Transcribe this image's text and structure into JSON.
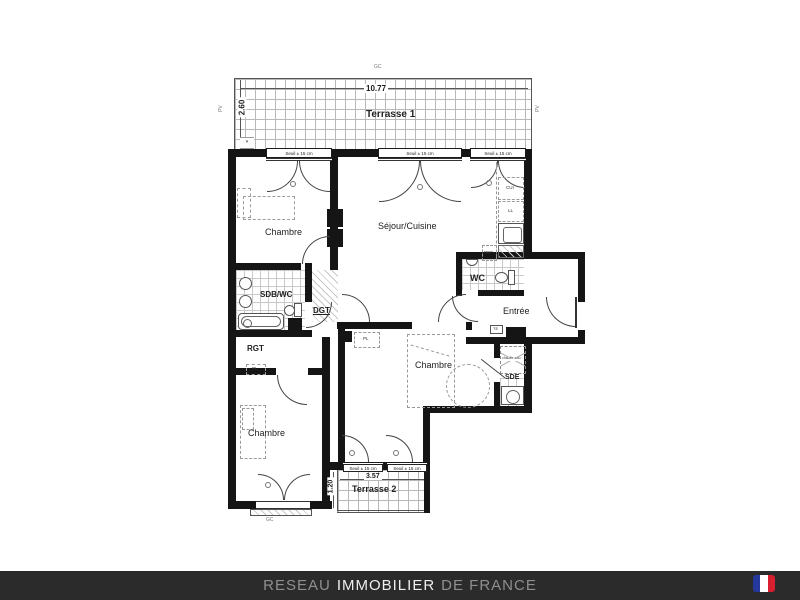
{
  "plan": {
    "terrace1": {
      "label": "Terrasse 1",
      "width_dim": "10.77",
      "depth_dim": "2.60"
    },
    "terrace2": {
      "label": "Terrasse 2",
      "width_dim": "3.57",
      "depth_dim": "1.20"
    },
    "threshold_label": "Seuil ± 15 cm",
    "markers": {
      "guardrail": "GC",
      "glazing": "PV"
    },
    "rooms": {
      "bedroom1": "Chambre",
      "living": "Séjour/Cuisine",
      "bathroom": "SDB/WC",
      "hallway": "DGT",
      "storage": "RGT",
      "wc": "WC",
      "entry": "Entrée",
      "bedroom2": "Chambre",
      "shower_room": "SDE",
      "bedroom3": "Chambre"
    },
    "appliances": {
      "cooker": "CUI",
      "washing_machine": "LL",
      "fridge": "REF",
      "closet": "PL",
      "electrical_panel": "TE",
      "water_heater": "chauffe-eau"
    }
  },
  "footer": {
    "brand_prefix": "RESEAU",
    "brand_main": "IMMOBILIER",
    "brand_suffix": "DE FRANCE",
    "flag_colors": {
      "blue": "#24399b",
      "white": "#ffffff",
      "red": "#d81f30"
    }
  }
}
